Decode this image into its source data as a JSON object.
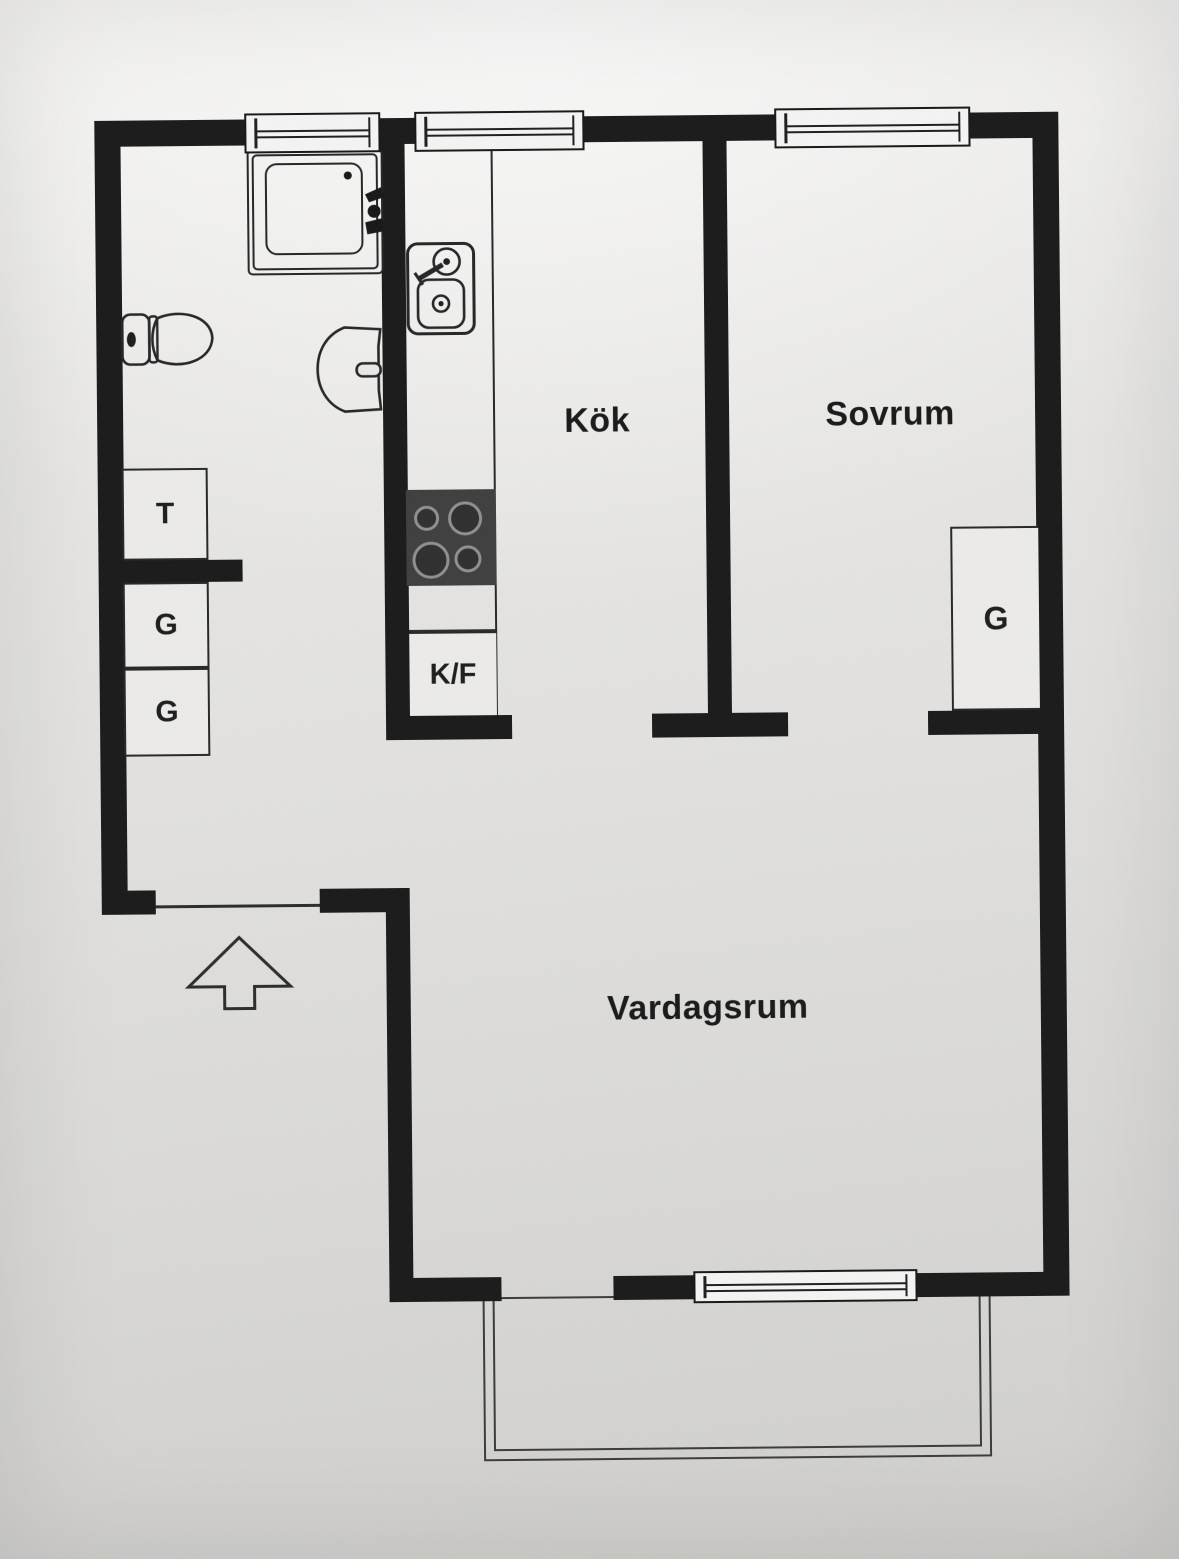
{
  "document": {
    "type": "apartment-floor-plan",
    "style": "scanned black-and-white plan photo"
  },
  "rooms": {
    "kitchen": "Kök",
    "bedroom": "Sovrum",
    "living_room": "Vardagsrum"
  },
  "closets": {
    "drying_cabinet": "T",
    "hall_wardrobe_1": "G",
    "hall_wardrobe_2": "G",
    "bedroom_wardrobe": "G",
    "fridge_freezer": "K/F"
  },
  "fixtures": [
    "shower",
    "toilet",
    "washbasin",
    "kitchen-sink",
    "stove",
    "entry-arrow",
    "balcony",
    "windows"
  ],
  "colors": {
    "wall": "#191919",
    "line": "#2b2b2b",
    "paper_light": "#f3f2f0",
    "paper_dark": "#cfcecb",
    "stove": "#3e3e3e"
  }
}
